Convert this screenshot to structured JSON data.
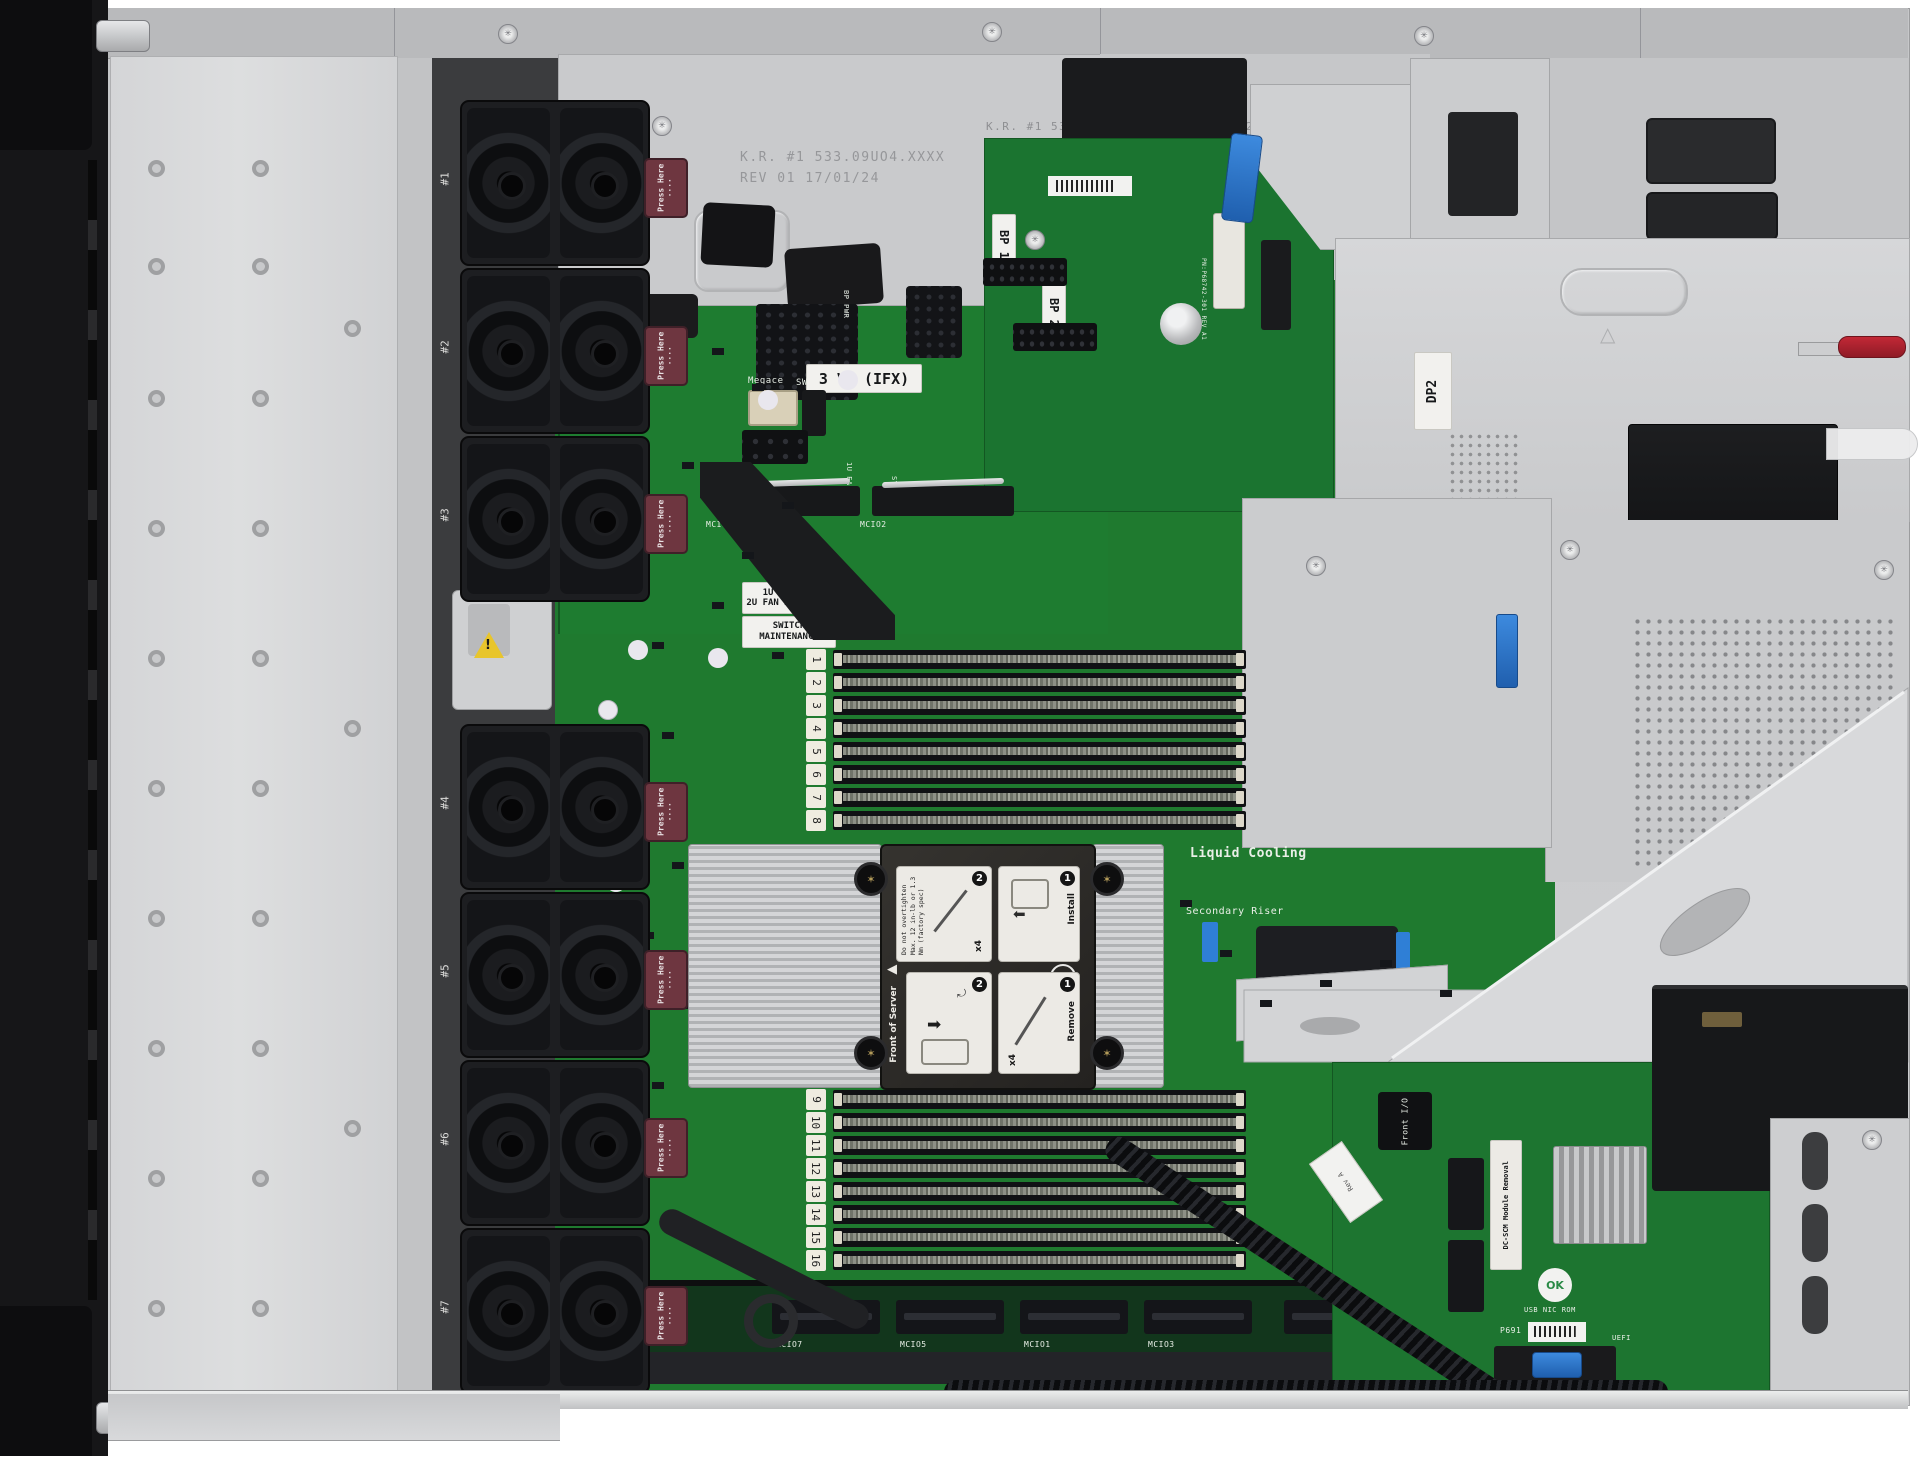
{
  "scene": {
    "description": "Top-down interior view of a 1U rack server with the access panel removed"
  },
  "colors": {
    "pcb": "#1f7a2f",
    "pcb_dark": "#1b7430",
    "metal": "#c9cacc",
    "metal_light": "#dcdddf",
    "bezel": "#161618",
    "fan_black": "#1d1e21",
    "press_maroon": "#6e3640",
    "latch_blue": "#2f7fd6",
    "handle_red": "#b5242e",
    "torx_gold": "#b39b5a"
  },
  "chassis": {
    "stamp_left_line1": "K.R. #1 533.09UO4.XXXX",
    "stamp_left_line2": "REV 01 17/01/24",
    "stamp_right": "K.R. #1 533.09U0D.XXX R01 10/01/24",
    "psu_blank_label": "DP2"
  },
  "fans": {
    "press_label": "Press Here",
    "press_dots": "····",
    "labels": [
      "#1",
      "#2",
      "#3",
      "#4",
      "#5",
      "#6",
      "#7"
    ]
  },
  "fan_board": {
    "vr_label": "3 VR (IFX)",
    "connector_silk": "Megace",
    "sw_silk": "SW",
    "fan1_silk": "1U FAN 1",
    "sys_pwr_silk": "SYS PWR",
    "bp_pwr_silk": "BP PWR",
    "fan2_silk_line1": "1U",
    "fan2_silk_line2": "2U FAN 2",
    "switch_silk_line1": "SWITCH",
    "switch_silk_line2": "MAINTENANCE"
  },
  "power_board": {
    "bp1": "BP 1",
    "bp2": "BP 2",
    "pn_silk": "PN:P68742-301 REV A1"
  },
  "memory": {
    "upper_slots": [
      "1",
      "2",
      "3",
      "4",
      "5",
      "6",
      "7",
      "8"
    ],
    "lower_slots": [
      "9",
      "10",
      "11",
      "12",
      "13",
      "14",
      "15",
      "16"
    ],
    "proc_silk": "PROC"
  },
  "heatsink_label": {
    "install": "Install",
    "remove": "Remove",
    "torx_size": "T30",
    "screw_count": "x4",
    "warning_line1": "Do not overtighten",
    "warning_line2": "Max. 12 in-lb or 1.3",
    "warning_line3": "Nm (factory spec)",
    "front_marker": "Front of Server",
    "step_one": "1",
    "step_two": "2"
  },
  "cooling": {
    "liquid_silk": "Liquid Cooling",
    "riser_silk": "Secondary Riser"
  },
  "io_board": {
    "front_io_label": "Front I/O",
    "dcscm_label": "DC-SCM Module Removal",
    "ok_badge": "OK",
    "rom_silk": "USB NIC ROM",
    "pn_silk": "P691",
    "uefi_silk": "UEFI",
    "flag_silk": "Rev A"
  },
  "connectors": {
    "mcio_mid": [
      "MCIO4",
      "MCIO2"
    ],
    "mcio_front": [
      "MCIO7",
      "MCIO5",
      "MCIO1",
      "MCIO3"
    ]
  },
  "icons": {
    "arrow_left": "⬅",
    "arrow_right": "➡",
    "torx_star": "✳",
    "warning_mark": "!",
    "triangle_left": "◀",
    "curve_arrow": "⤾",
    "triangle_up": "△"
  }
}
